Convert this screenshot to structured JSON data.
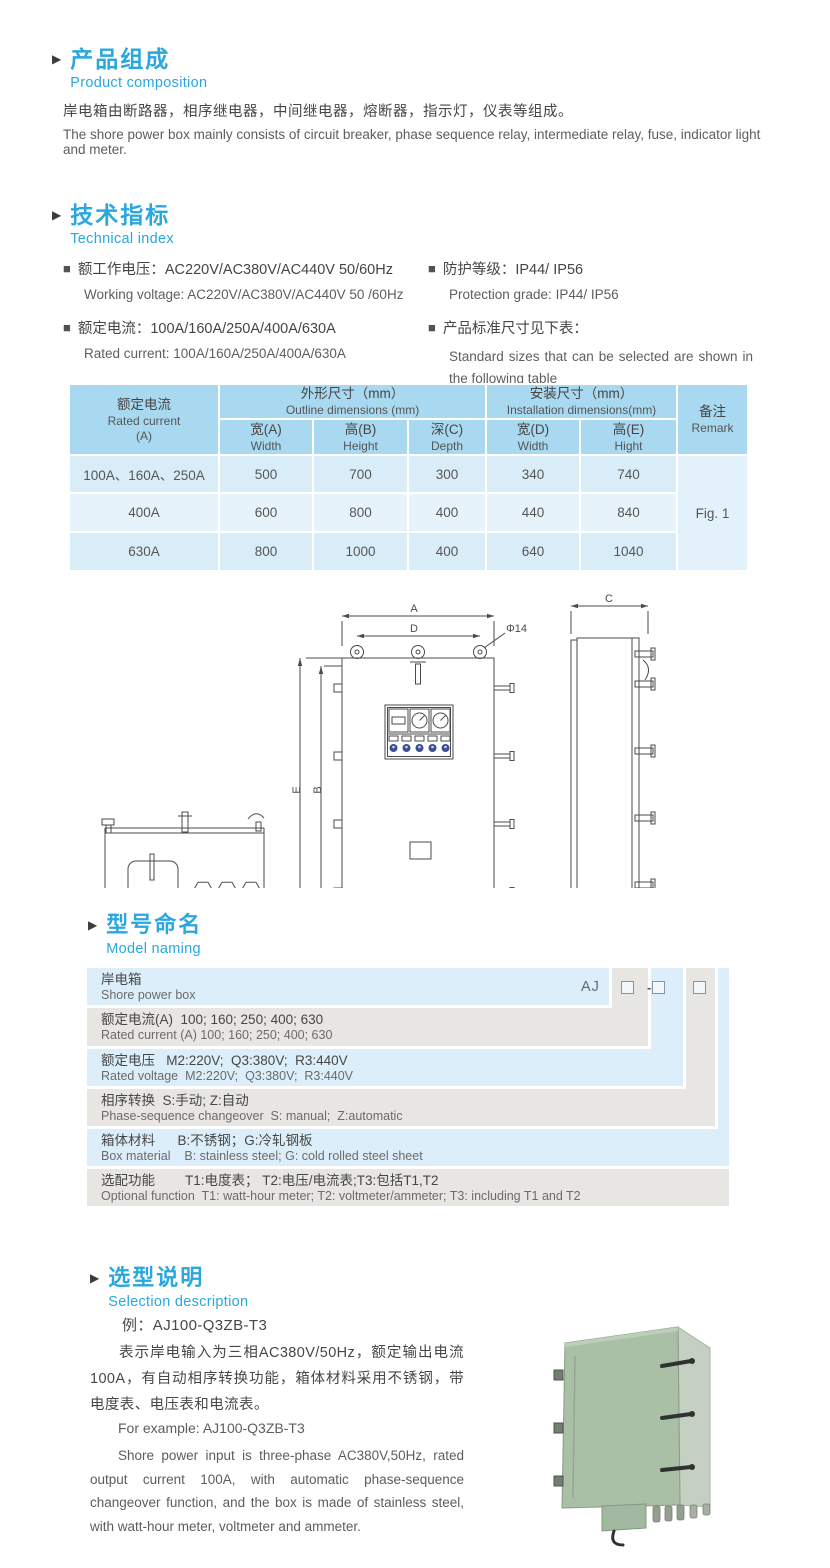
{
  "icons": {
    "section_marker": "▶",
    "bullet": "■"
  },
  "section_product_composition": {
    "title_cn": "产品组成",
    "title_en": "Product  composition",
    "body_cn": "岸电箱由断路器，相序继电器，中间继电器，熔断器，指示灯，仪表等组成。",
    "body_en": "The shore power box mainly consists of circuit breaker, phase sequence relay, intermediate relay, fuse, indicator light and meter."
  },
  "section_technical_index": {
    "title_cn": "技术指标",
    "title_en": "Technical index",
    "spec1_cn": "额工作电压：AC220V/AC380V/AC440V  50/60Hz",
    "spec1_en": "Working voltage: AC220V/AC380V/AC440V 50 /60Hz",
    "spec2_cn": "额定电流：100A/160A/250A/400A/630A",
    "spec2_en": "Rated current: 100A/160A/250A/400A/630A",
    "spec3_cn": "防护等级：IP44/ IP56",
    "spec3_en": "Protection grade: IP44/ IP56",
    "spec4_cn": "产品标准尺寸见下表：",
    "spec4_en": "Standard sizes that can be selected are shown in the following table"
  },
  "dimensions_table": {
    "col1_cn": "额定电流",
    "col1_en": "Rated current",
    "col1_unit": "(A)",
    "outline_cn": "外形尺寸（mm）",
    "outline_en": "Outline dimensions (mm)",
    "install_cn": "安装尺寸（mm）",
    "install_en": "Installation dimensions(mm)",
    "remark_cn": "备注",
    "remark_en": "Remark",
    "sub": [
      {
        "cn": "宽(A)",
        "en": "Width"
      },
      {
        "cn": "高(B)",
        "en": "Height"
      },
      {
        "cn": "深(C)",
        "en": "Depth"
      },
      {
        "cn": "宽(D)",
        "en": "Width"
      },
      {
        "cn": "高(E)",
        "en": "Hight"
      }
    ],
    "rows": [
      {
        "current": "100A、160A、250A",
        "w": "500",
        "h": "700",
        "d": "300",
        "iw": "340",
        "ih": "740"
      },
      {
        "current": "400A",
        "w": "600",
        "h": "800",
        "d": "400",
        "iw": "440",
        "ih": "840"
      },
      {
        "current": "630A",
        "w": "800",
        "h": "1000",
        "d": "400",
        "iw": "640",
        "ih": "1040"
      }
    ],
    "remark_value": "Fig. 1"
  },
  "drawing_labels": {
    "dim_a": "A",
    "dim_b": "B",
    "dim_c": "C",
    "dim_d": "D",
    "dim_e": "E",
    "hole": "Φ14"
  },
  "model_naming": {
    "title_cn": "型号命名",
    "title_en": "Model naming",
    "code_prefix": "AJ",
    "code_dash": "-",
    "rows": [
      {
        "cn": "岸电箱",
        "en": "Shore power box"
      },
      {
        "cn": "额定电流(A)  100; 160; 250; 400; 630",
        "en": "Rated current (A) 100; 160; 250; 400; 630"
      },
      {
        "cn": "额定电压   M2:220V;  Q3:380V;  R3:440V",
        "en": "Rated voltage  M2:220V;  Q3:380V;  R3:440V"
      },
      {
        "cn": "相序转换  S:手动; Z:自动",
        "en": "Phase-sequence changeover  S: manual;  Z:automatic"
      },
      {
        "cn": "箱体材料      B:不锈钢；G:冷轧钢板",
        "en": "Box material    B: stainless steel; G: cold rolled steel sheet"
      },
      {
        "cn": "选配功能        T1:电度表； T2:电压/电流表;T3:包括T1,T2",
        "en": "Optional function  T1: watt-hour meter; T2: voltmeter/ammeter; T3: including T1 and T2"
      }
    ]
  },
  "section_selection": {
    "title_cn": "选型说明",
    "title_en": "Selection description",
    "example_cn": "例：AJ100-Q3ZB-T3",
    "desc_cn": "表示岸电输入为三相AC380V/50Hz，额定输出电流100A，有自动相序转换功能，箱体材料采用不锈钢，带电度表、电压表和电流表。",
    "example_en": "For example: AJ100-Q3ZB-T3",
    "desc_en": "Shore power input is three-phase AC380V,50Hz, rated output current 100A, with automatic phase-sequence changeover function, and the box is made of stainless steel, with watt-hour meter, voltmeter and ammeter."
  }
}
